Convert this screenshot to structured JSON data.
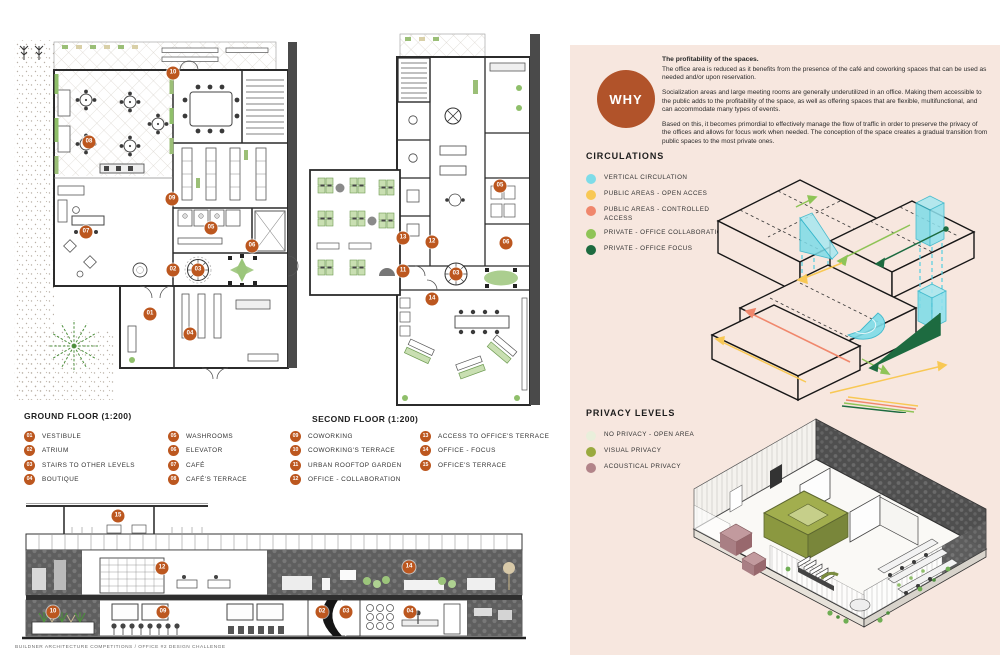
{
  "colors": {
    "accent": "#b1532a",
    "badge": "#bc571f",
    "panel": "#f7e7df"
  },
  "plans": {
    "ground": {
      "title": "GROUND FLOOR (1:200)",
      "markers": [
        "10",
        "08",
        "09",
        "07",
        "05",
        "06",
        "02",
        "03",
        "01",
        "04"
      ]
    },
    "second": {
      "title": "SECOND FLOOR (1:200)",
      "markers": [
        "05",
        "13",
        "12",
        "06",
        "11",
        "03",
        "14"
      ]
    },
    "section": {
      "markers": [
        "15",
        "12",
        "14",
        "10",
        "09",
        "02",
        "03",
        "04"
      ]
    }
  },
  "legend": {
    "items": [
      {
        "num": "01",
        "label": "VESTIBULE"
      },
      {
        "num": "02",
        "label": "ATRIUM"
      },
      {
        "num": "03",
        "label": "STAIRS TO OTHER LEVELS"
      },
      {
        "num": "04",
        "label": "BOUTIQUE"
      },
      {
        "num": "05",
        "label": "WASHROOMS"
      },
      {
        "num": "06",
        "label": "ELEVATOR"
      },
      {
        "num": "07",
        "label": "CAFÉ"
      },
      {
        "num": "08",
        "label": "CAFÉ'S TERRACE"
      },
      {
        "num": "09",
        "label": "COWORKING"
      },
      {
        "num": "10",
        "label": "COWORKING'S TERRACE"
      },
      {
        "num": "11",
        "label": "URBAN ROOFTOP GARDEN"
      },
      {
        "num": "12",
        "label": "OFFICE - COLLABORATION"
      },
      {
        "num": "13",
        "label": "ACCESS TO OFFICE'S TERRACE"
      },
      {
        "num": "14",
        "label": "OFFICE - FOCUS"
      },
      {
        "num": "15",
        "label": "OFFICE'S TERRACE"
      }
    ]
  },
  "why": {
    "label": "WHY",
    "heading": "The profitability of the spaces.",
    "paragraphs": [
      "The office area is reduced as it benefits from the presence of the café and coworking spaces that can be used as needed and/or upon reservation.",
      "Socialization areas and large meeting rooms are generally underutilized in an office. Making them accessible to the public adds to the profitability of the space, as well as offering spaces that are flexible, multifunctional, and can accommodate many types of events.",
      "Based on this, it becomes primordial to effectively manage the flow of traffic in order to preserve the privacy of the offices and allows for focus work when needed. The conception of the space creates a gradual transition from public spaces to the most private ones."
    ]
  },
  "circulations": {
    "title": "CIRCULATIONS",
    "items": [
      {
        "color": "#7edce8",
        "label": "VERTICAL CIRCULATION"
      },
      {
        "color": "#f8c854",
        "label": "PUBLIC AREAS - OPEN ACCES"
      },
      {
        "color": "#f0876c",
        "label": "PUBLIC AREAS - CONTROLLED ACCESS"
      },
      {
        "color": "#8fc457",
        "label": "PRIVATE - OFFICE COLLABORATION"
      },
      {
        "color": "#1d6b40",
        "label": "PRIVATE - OFFICE FOCUS"
      }
    ]
  },
  "privacy": {
    "title": "PRIVACY LEVELS",
    "items": [
      {
        "color": "#e9efdb",
        "label": "NO PRIVACY - OPEN AREA"
      },
      {
        "color": "#9aaa3f",
        "label": "VISUAL PRIVACY"
      },
      {
        "color": "#b28489",
        "label": "ACOUSTICAL PRIVACY"
      }
    ]
  },
  "footer": {
    "text": "BUILDNER ARCHITECTURE COMPETITIONS / OFFICE #2 DESIGN CHALLENGE"
  }
}
